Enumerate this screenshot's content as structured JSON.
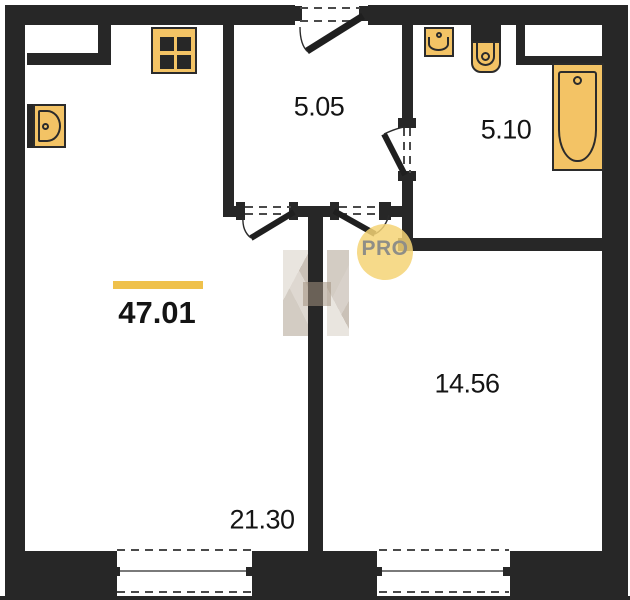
{
  "plan": {
    "type": "apartment-floor-plan",
    "total_area": {
      "value": "47.01"
    },
    "rooms": [
      {
        "id": "hallway",
        "area": "5.05"
      },
      {
        "id": "bathroom",
        "area": "5.10"
      },
      {
        "id": "bedroom",
        "area": "14.56"
      },
      {
        "id": "living-kitchen",
        "area": "21.30"
      }
    ],
    "watermark": {
      "label": "PRO"
    },
    "fixtures": [
      "stove",
      "kitchen-sink",
      "bathroom-sink",
      "toilet",
      "bathtub"
    ],
    "doors": [
      "entrance-door",
      "living-room-door",
      "bedroom-door",
      "bathroom-door"
    ],
    "windows_count": 2,
    "colors": {
      "wall": "#272727",
      "fixture": "#F3C365",
      "fixture_border": "#2b2b2b",
      "accent_bar": "#EFC14B",
      "watermark_circle": "rgba(245,211,117,.85)",
      "watermark_text": "#8F8E87"
    }
  }
}
